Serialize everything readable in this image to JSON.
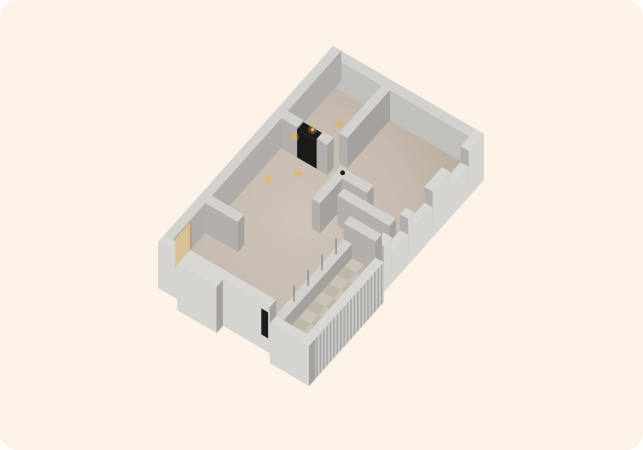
{
  "canvas": {
    "w": 643,
    "h": 450
  },
  "background": {
    "outer": "#fffdfa",
    "card": "#fdf2e8",
    "corner_radius": 18
  },
  "palette": {
    "cap": "#d2d1ce",
    "cap_ext": "#d8d7d4",
    "face_se": "#a5a19d",
    "face_sw": "#b3afaa",
    "inner_ne": "#c2c0bc",
    "inner_nw": "#b0ada9",
    "ext_out": "#d5d4d1",
    "floor_c0": "#cfc4b8",
    "floor_c1": "#c6baae",
    "floor_c2": "#b1a598",
    "tile_a": "#cbc3b8",
    "tile_b": "#c0b7ab",
    "rail_rib_a": "#cbcac7",
    "rail_rib_b": "#a7a6a3",
    "dark": "#1d1b19",
    "door_tan": "#d8c097",
    "door_tan_edge": "#b79c73",
    "mullion": "#85827e",
    "light_core": "#eab253",
    "light_glow": "rgba(233,178,83,0.30)"
  },
  "iso": {
    "origin": [
      333,
      76
    ],
    "ax": [
      15.1,
      8.8
    ],
    "ay": [
      -11.667,
      13.067
    ]
  },
  "floor": {
    "outline": [
      [
        0,
        0
      ],
      [
        10,
        0
      ],
      [
        10,
        15
      ],
      [
        4.3,
        15
      ],
      [
        4.3,
        15.55
      ],
      [
        1.7,
        15.55
      ],
      [
        1.7,
        15
      ],
      [
        0,
        15
      ]
    ]
  },
  "tiles": {
    "x0": 7.9,
    "y0": 8.6,
    "x1": 9.45,
    "y1": 14.45,
    "nx": 2,
    "ny": 9
  },
  "walls": [
    {
      "name": "wall-ne",
      "x0": 0,
      "y0": 0,
      "x1": 10,
      "y1": 0.55,
      "z0": 0,
      "z1": 30,
      "top": "cap",
      "se": "face_se",
      "sw": "inner_ne"
    },
    {
      "name": "wall-nw",
      "x0": 0,
      "y0": 0,
      "x1": 0.55,
      "y1": 15,
      "z0": 0,
      "z1": 30,
      "top": "cap",
      "se": "inner_nw",
      "sw": "ext_out"
    },
    {
      "name": "wall-bedroom-divider",
      "x0": 3.65,
      "y0": 0.55,
      "x1": 4.2,
      "y1": 4.2,
      "z0": 0,
      "z1": 30,
      "top": "cap",
      "se": "face_se",
      "sw": "face_sw"
    },
    {
      "name": "wall-w2-left",
      "x0": 0.55,
      "y0": 4.6,
      "x1": 1.6,
      "y1": 5.15,
      "z0": 0,
      "z1": 30,
      "top": "cap",
      "se": "face_se",
      "sw": "face_sw"
    },
    {
      "name": "doorway-dark",
      "x0": 1.6,
      "y0": 4.6,
      "x1": 2.9,
      "y1": 5.15,
      "z0": 0,
      "z1": 28,
      "top": "dark",
      "se": "dark",
      "sw": "dark"
    },
    {
      "name": "wall-w2-right",
      "x0": 2.9,
      "y0": 4.6,
      "x1": 3.6,
      "y1": 5.15,
      "z0": 0,
      "z1": 30,
      "top": "cap",
      "se": "face_se",
      "sw": "face_sw"
    },
    {
      "name": "wall-l-leg-b",
      "x0": 5.0,
      "y0": 5.85,
      "x1": 5.55,
      "y1": 8.3,
      "z0": 0,
      "z1": 30,
      "top": "cap",
      "se": "face_se",
      "sw": "face_sw"
    },
    {
      "name": "wall-l-leg-a",
      "x0": 5.55,
      "y0": 5.85,
      "x1": 7.2,
      "y1": 6.4,
      "z0": 0,
      "z1": 30,
      "top": "cap",
      "se": "face_se",
      "sw": "face_sw"
    },
    {
      "name": "wall-living-divider",
      "x0": 6.0,
      "y0": 6.85,
      "x1": 9.45,
      "y1": 7.4,
      "z0": 0,
      "z1": 30,
      "top": "cap",
      "se": "face_se",
      "sw": "face_sw"
    },
    {
      "name": "wall-room-c-bottom",
      "x0": 0.55,
      "y0": 11.1,
      "x1": 2.7,
      "y1": 11.65,
      "z0": 0,
      "z1": 30,
      "top": "cap",
      "se": "face_se",
      "sw": "face_sw"
    },
    {
      "name": "wall-se-1",
      "x0": 9.45,
      "y0": 0,
      "x1": 10,
      "y1": 1.3,
      "z0": -16,
      "z1": 30,
      "top": "cap_ext",
      "se": "ext_out",
      "sw": "face_sw"
    },
    {
      "name": "window-se-1",
      "x0": 9.45,
      "y0": 1.3,
      "x1": 10,
      "y1": 2.9,
      "z0": -16,
      "z1": 14,
      "top": "cap_ext",
      "se": "ext_out",
      "sw": "face_sw"
    },
    {
      "name": "wall-se-2",
      "x0": 9.45,
      "y0": 2.9,
      "x1": 10,
      "y1": 4.4,
      "z0": -16,
      "z1": 30,
      "top": "cap_ext",
      "se": "ext_out",
      "sw": "face_sw"
    },
    {
      "name": "window-se-2",
      "x0": 9.45,
      "y0": 4.4,
      "x1": 10,
      "y1": 6.0,
      "z0": -16,
      "z1": 14,
      "top": "cap_ext",
      "se": "ext_out",
      "sw": "face_sw"
    },
    {
      "name": "wall-se-3",
      "x0": 9.45,
      "y0": 6.0,
      "x1": 10,
      "y1": 6.5,
      "z0": -16,
      "z1": 30,
      "top": "cap_ext",
      "se": "ext_out",
      "sw": "face_sw"
    },
    {
      "name": "window-se-3",
      "x0": 9.45,
      "y0": 6.5,
      "x1": 10,
      "y1": 7.9,
      "z0": -16,
      "z1": 14,
      "top": "cap_ext",
      "se": "ext_out",
      "sw": "face_sw"
    },
    {
      "name": "wall-se-4",
      "x0": 9.45,
      "y0": 7.9,
      "x1": 10,
      "y1": 8.6,
      "z0": -16,
      "z1": 30,
      "top": "cap_ext",
      "se": "ext_out",
      "sw": "face_sw"
    },
    {
      "name": "wall-balcony-end",
      "x0": 7.35,
      "y0": 8.05,
      "x1": 9.45,
      "y1": 8.6,
      "z0": 0,
      "z1": 30,
      "top": "cap",
      "se": "face_se",
      "sw": "face_sw"
    },
    {
      "name": "balcony-window-sill",
      "x0": 7.35,
      "y0": 8.6,
      "x1": 7.9,
      "y1": 14.45,
      "z0": 0,
      "z1": 14,
      "top": "cap",
      "se": "face_se",
      "sw": "face_sw"
    },
    {
      "name": "balcony-railing",
      "x0": 9.45,
      "y0": 8.6,
      "x1": 10,
      "y1": 15,
      "z0": -26,
      "z1": 14,
      "top": "cap_ext",
      "se": "RIB",
      "sw": "ext_out"
    },
    {
      "name": "wall-sw-1",
      "x0": 0,
      "y0": 14.45,
      "x1": 1.7,
      "y1": 15,
      "z0": -16,
      "z1": 30,
      "top": "cap_ext",
      "se": "face_se",
      "sw": "ext_out"
    },
    {
      "name": "wall-sw-bay",
      "x0": 1.7,
      "y0": 14.45,
      "x1": 4.3,
      "y1": 15.55,
      "z0": -16,
      "z1": 30,
      "top": "cap_ext",
      "se": "face_se",
      "sw": "ext_out"
    },
    {
      "name": "wall-sw-2",
      "x0": 4.3,
      "y0": 14.45,
      "x1": 7.4,
      "y1": 15,
      "z0": -16,
      "z1": 30,
      "top": "cap_ext",
      "se": "face_se",
      "sw": "ext_out"
    },
    {
      "name": "wall-sw-balcony",
      "x0": 7.4,
      "y0": 14.45,
      "x1": 10,
      "y1": 15,
      "z0": -26,
      "z1": 14,
      "top": "cap_ext",
      "se": "face_se",
      "sw": "ext_out"
    }
  ],
  "panels": [
    {
      "name": "entry-door-panel",
      "plane": "x",
      "at": 0.56,
      "a0": 12.85,
      "a1": 14.25,
      "z0": 0,
      "z1": 28,
      "fill": "door_tan"
    },
    {
      "name": "entry-door-frame",
      "plane": "x",
      "at": 0.56,
      "a0": 12.85,
      "a1": 13.0,
      "z0": 0,
      "z1": 28,
      "fill": "door_tan_edge"
    },
    {
      "name": "dark-door-slot",
      "plane": "y",
      "at": 15.01,
      "a0": 6.85,
      "a1": 7.3,
      "z0": -2,
      "z1": 24,
      "fill": "dark"
    }
  ],
  "mullions": [
    {
      "x": 7.62,
      "y": 9.6,
      "z0": 14,
      "z1": 30
    },
    {
      "x": 7.62,
      "y": 10.8,
      "z0": 14,
      "z1": 30
    },
    {
      "x": 7.62,
      "y": 12.0,
      "z0": 14,
      "z1": 30
    },
    {
      "x": 7.62,
      "y": 13.2,
      "z0": 14,
      "z1": 30
    }
  ],
  "lights": [
    [
      1.2,
      3.3
    ],
    [
      2.1,
      2.2
    ],
    [
      0.7,
      4.2
    ],
    [
      1.2,
      7.1
    ],
    [
      2.3,
      5.9
    ]
  ],
  "cap_dot": [
    5.35,
    6.1
  ]
}
